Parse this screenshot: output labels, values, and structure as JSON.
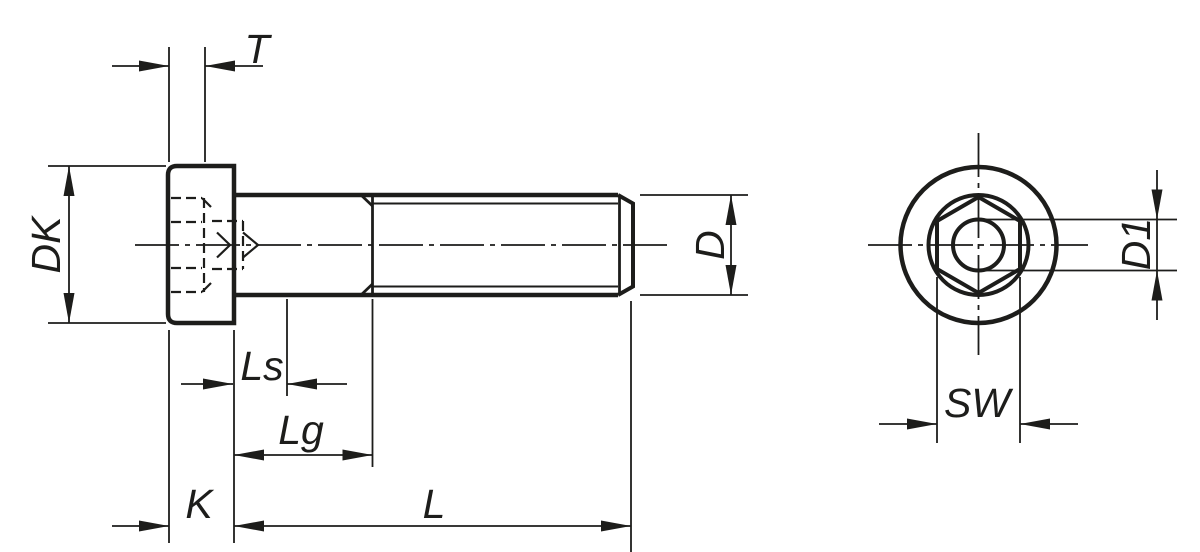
{
  "drawing": {
    "type": "technical-drawing-socket-head-screw",
    "labels": {
      "t": "T",
      "dk": "DK",
      "ls": "Ls",
      "lg": "Lg",
      "k": "K",
      "l": "L",
      "d": "D",
      "d1": "D1",
      "sw": "SW"
    },
    "colors": {
      "line": "#1d1d1b",
      "background": "#ffffff"
    }
  }
}
